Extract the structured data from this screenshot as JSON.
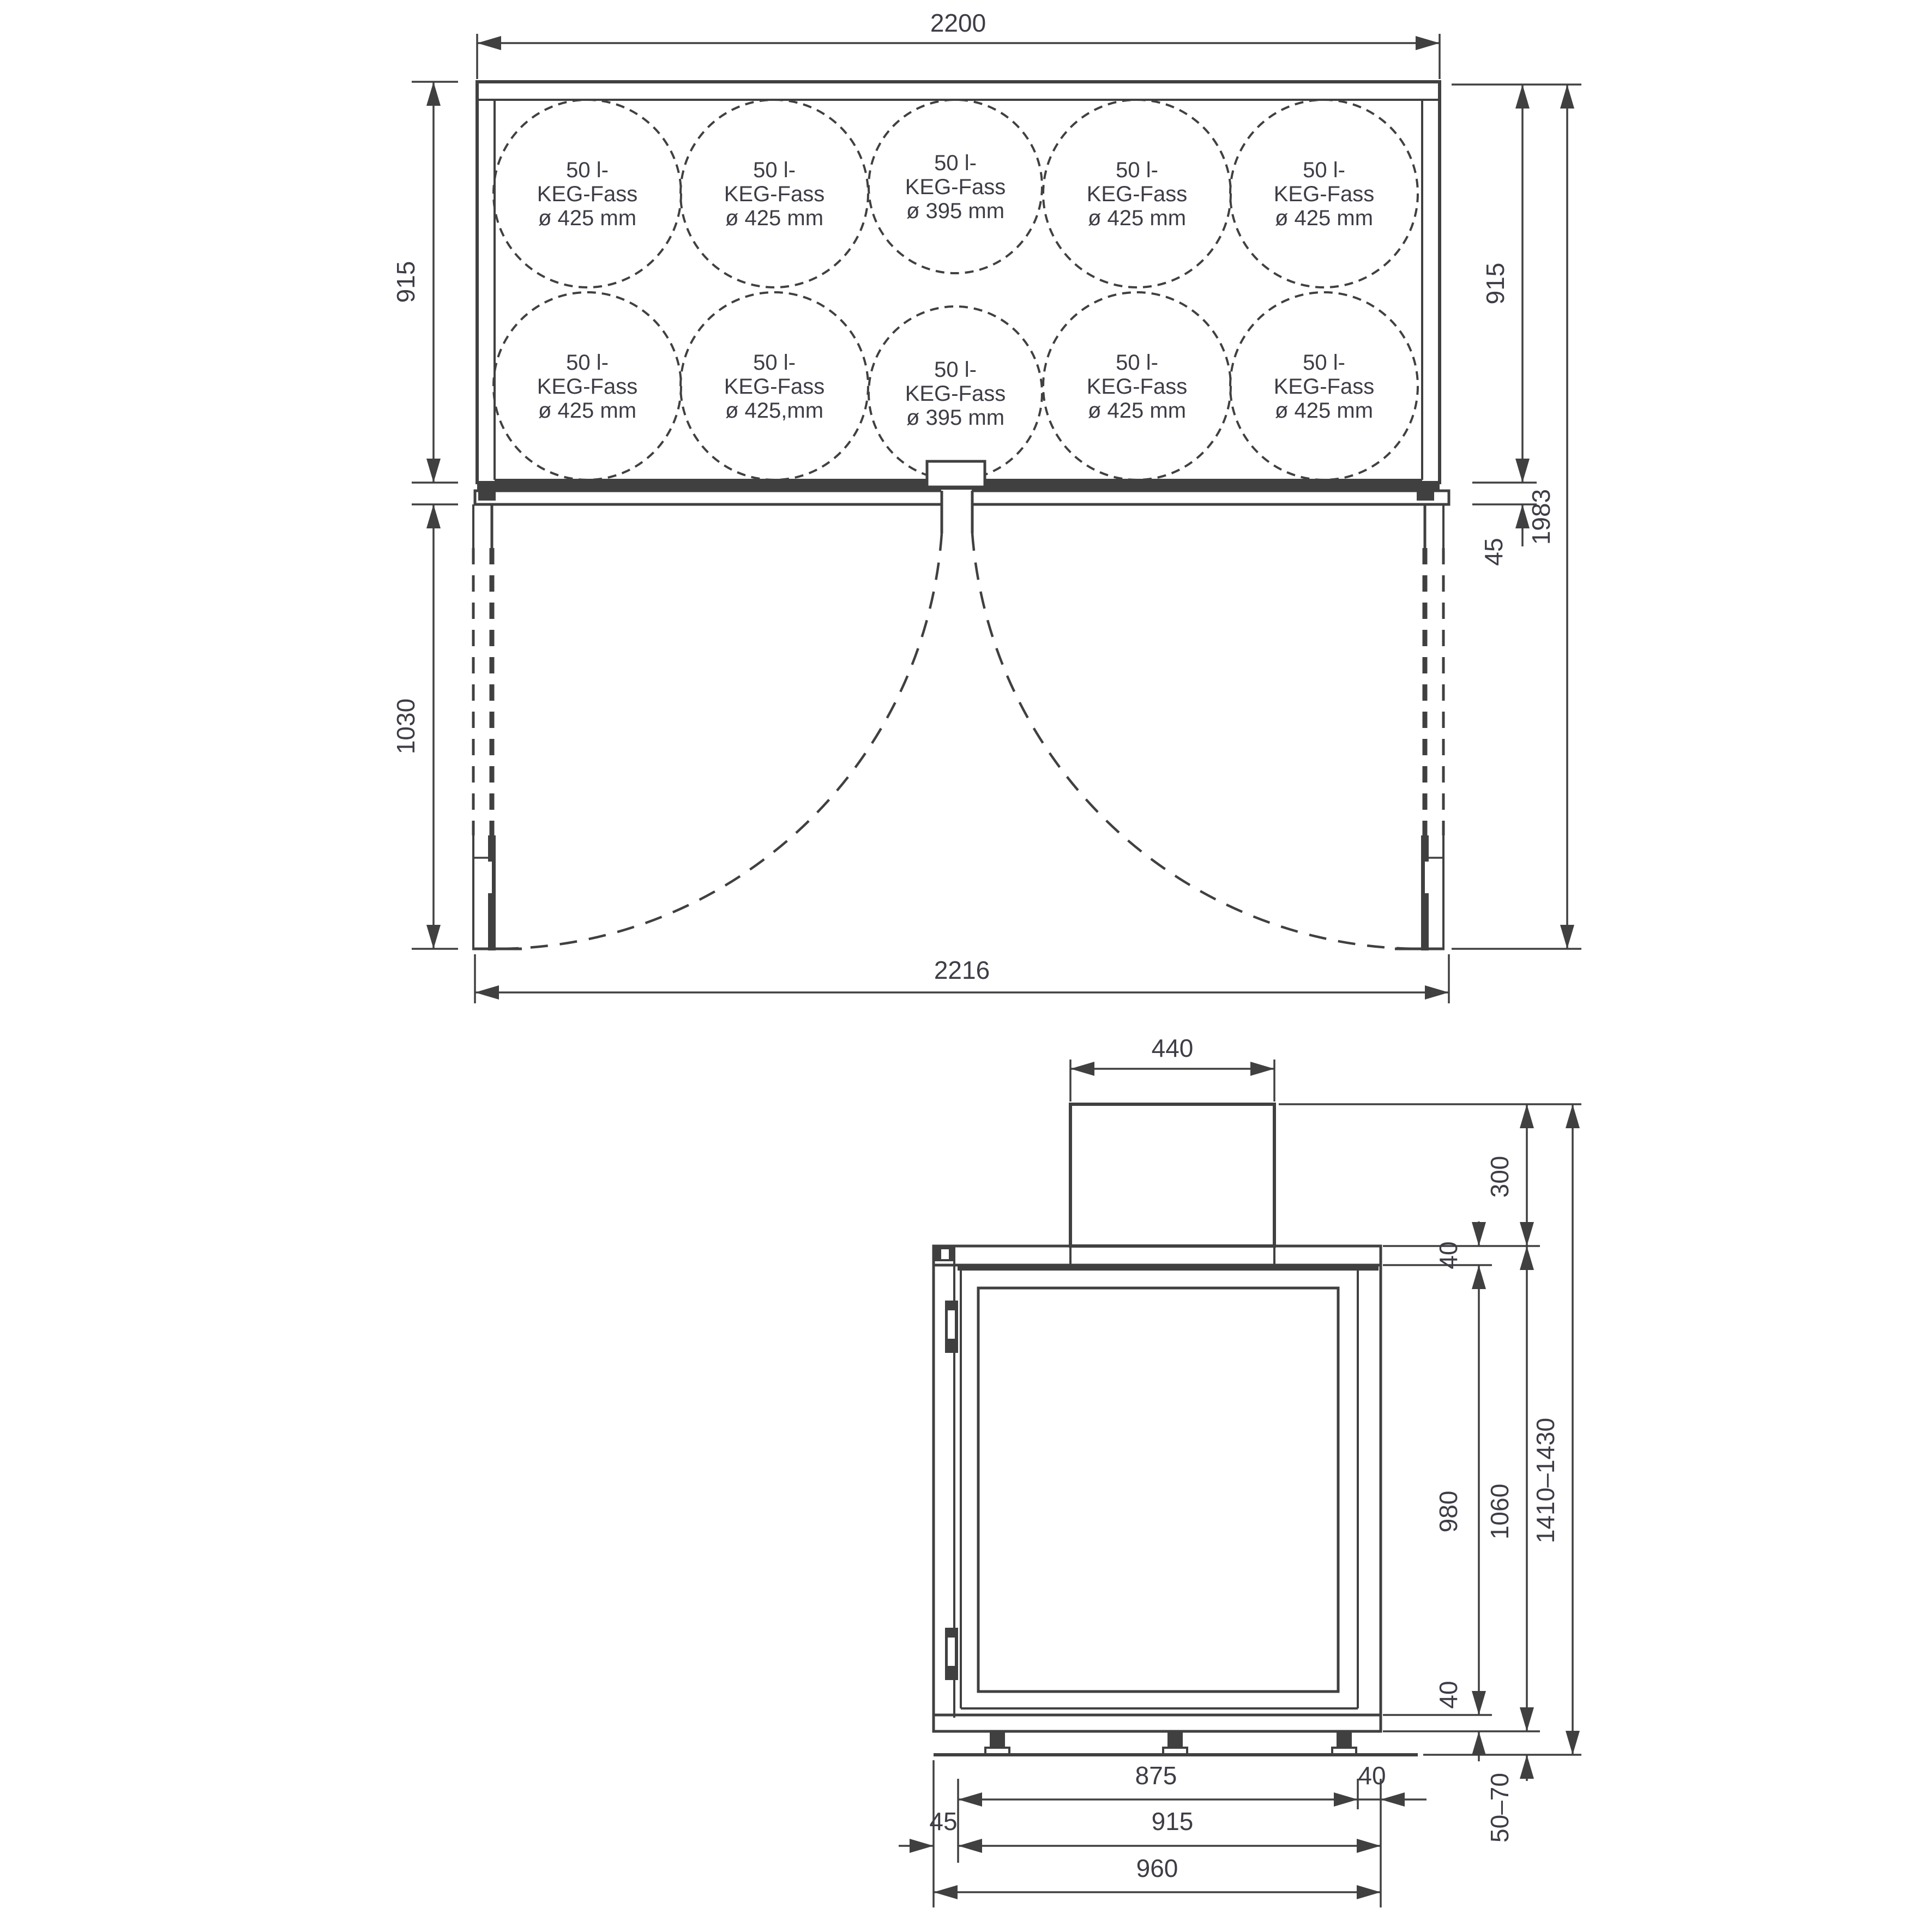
{
  "colors": {
    "background": "#ffffff",
    "line": "#404040",
    "text": "#3d3d46"
  },
  "plan_view": {
    "dim_width_top": "2200",
    "dim_depth_left": "915",
    "dim_door_swing_left": "1030",
    "dim_depth_right": "915",
    "dim_front_overhang_right": "45",
    "dim_total_depth_right": "1983",
    "dim_width_bottom": "2216",
    "kegs": [
      {
        "row": 0,
        "col": 0,
        "size": "large",
        "lines": [
          "50 l-",
          "KEG-Fass",
          "ø 425 mm"
        ]
      },
      {
        "row": 0,
        "col": 1,
        "size": "large",
        "lines": [
          "50 l-",
          "KEG-Fass",
          "ø 425 mm"
        ]
      },
      {
        "row": 0,
        "col": 2,
        "size": "small",
        "lines": [
          "50 l-",
          "KEG-Fass",
          "ø 395 mm"
        ]
      },
      {
        "row": 0,
        "col": 3,
        "size": "large",
        "lines": [
          "50 l-",
          "KEG-Fass",
          "ø 425 mm"
        ]
      },
      {
        "row": 0,
        "col": 4,
        "size": "large",
        "lines": [
          "50 l-",
          "KEG-Fass",
          "ø 425 mm"
        ]
      },
      {
        "row": 1,
        "col": 0,
        "size": "large",
        "lines": [
          "50 l-",
          "KEG-Fass",
          "ø 425 mm"
        ]
      },
      {
        "row": 1,
        "col": 1,
        "size": "large",
        "lines": [
          "50 l-",
          "KEG-Fass",
          "ø 425,mm"
        ]
      },
      {
        "row": 1,
        "col": 2,
        "size": "small",
        "lines": [
          "50 l-",
          "KEG-Fass",
          "ø 395 mm"
        ]
      },
      {
        "row": 1,
        "col": 3,
        "size": "large",
        "lines": [
          "50 l-",
          "KEG-Fass",
          "ø 425 mm"
        ]
      },
      {
        "row": 1,
        "col": 4,
        "size": "large",
        "lines": [
          "50 l-",
          "KEG-Fass",
          "ø 425 mm"
        ]
      }
    ]
  },
  "side_view": {
    "dim_condenser_width": "440",
    "dim_condenser_height": "300",
    "dim_lid_thickness": "40",
    "dim_interior_height": "980",
    "dim_body_height": "1060",
    "dim_total_height": "1410–1430",
    "dim_base_thickness": "40",
    "dim_feet_height": "50–70",
    "dim_interior_width": "875",
    "dim_right_wall_thickness": "40",
    "dim_inner_width": "915",
    "dim_door_thickness": "45",
    "dim_total_width": "960"
  }
}
